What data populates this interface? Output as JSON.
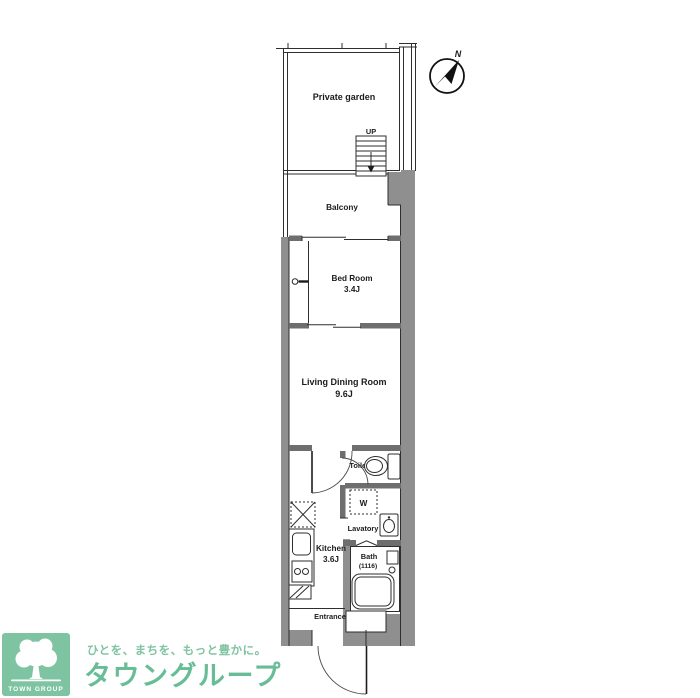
{
  "colors": {
    "exterior_wall_gray": "#8f8f8f",
    "interior_wall_gray": "#6e6e6e",
    "line_black": "#2e2e2e",
    "brand_green": "#7fc4a2",
    "brand_text_green": "#68bd96",
    "background": "#ffffff"
  },
  "plan": {
    "garden": "Private garden",
    "balcony": "Balcony",
    "bedroom": "Bed Room",
    "bedroom_size": "3.4J",
    "ldk": "Living Dining Room",
    "ldk_size": "9.6J",
    "kitchen": "Kitchen",
    "kitchen_size": "3.6J",
    "toilet": "Toilet",
    "lavatory": "Lavatory",
    "bath": "Bath",
    "bath_size": "(1116)",
    "entrance": "Entrance",
    "stairs_up": "UP",
    "north": "N",
    "washer": "W"
  },
  "footer": {
    "logo_badge": "TOWN GROUP",
    "tagline": "ひとを、まちを、もっと豊かに。",
    "brand": "タウングループ"
  }
}
